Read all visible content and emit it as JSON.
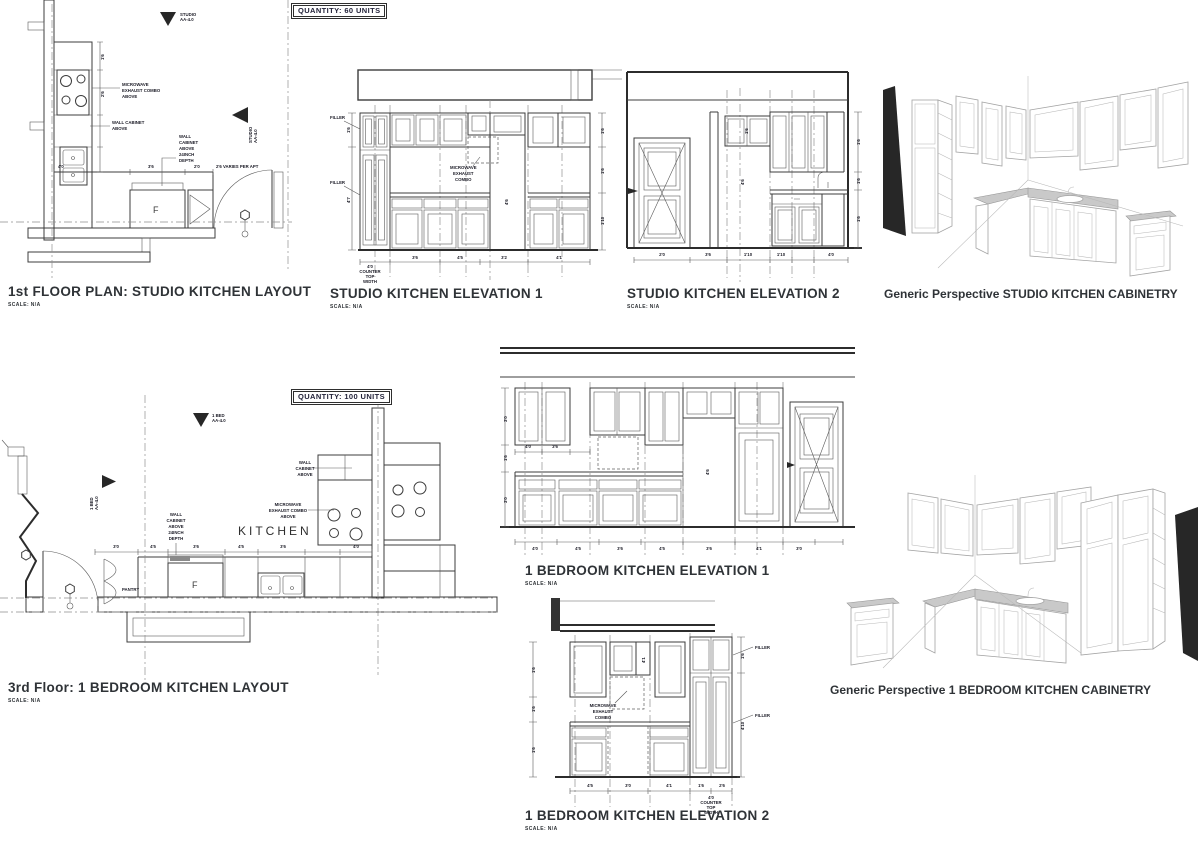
{
  "colors": {
    "line": "#3c3c3c",
    "grid": "#8f8f8f",
    "dark_fill": "#272727",
    "granite": "#c9c9c9",
    "title": "#2f3337"
  },
  "studio_plan": {
    "title": "1st FLOOR PLAN: STUDIO KITCHEN LAYOUT",
    "scale": "SCALE: N/A",
    "quantity": "QUANTITY: 60 UNITS",
    "fridge": "F",
    "marker_top": [
      "STUDIO",
      "AA-4.0"
    ],
    "marker_side": [
      "STUDIO",
      "AA-4.0"
    ],
    "note_microwave": [
      "MICROWAVE",
      "EXHAUST COMBO",
      "ABOVE"
    ],
    "note_wall_cabinet": [
      "WALL CABINET",
      "ABOVE"
    ],
    "note_wall_cabinet_depth": [
      "WALL",
      "CABINET",
      "ABOVE",
      "24INCH",
      "DEPTH"
    ],
    "dims": [
      "4'0",
      "3'6",
      "2'0",
      "2'6 VARIES PER APT",
      "1'6",
      "2'6"
    ]
  },
  "studio_el1": {
    "title": "STUDIO KITCHEN ELEVATION 1",
    "scale": "SCALE: N/A",
    "filler": "FILLER",
    "note_microwave": [
      "MICROWAVE",
      "EXHAUST",
      "COMBO"
    ],
    "counter_top": [
      "4'0",
      "COUNTER",
      "TOP",
      "WIDTH"
    ],
    "dims_bottom": [
      "3'6",
      "4'5",
      "3'2",
      "4'1"
    ],
    "dims_left": [
      "1'6",
      "4'7"
    ],
    "dims_right": [
      "1'6",
      "1'6",
      "1'10"
    ],
    "dim_fridge": "4'6"
  },
  "studio_el2": {
    "title": "STUDIO KITCHEN ELEVATION 2",
    "scale": "SCALE: N/A",
    "dims_bottom": [
      "2'0",
      "3'6",
      "1'10",
      "1'10",
      "4'0"
    ],
    "dims_right": [
      "1'6",
      "1'6",
      "1'6"
    ],
    "dim_tall": "4'6",
    "dim_upper": "1'6"
  },
  "studio_persp": {
    "title": "Generic Perspective STUDIO KITCHEN CABINETRY"
  },
  "bed_plan": {
    "title": "3rd Floor: 1 BEDROOM KITCHEN LAYOUT",
    "scale": "SCALE: N/A",
    "quantity": "QUANTITY: 100 UNITS",
    "kitchen": "KITCHEN",
    "pantry": "PANTRY",
    "fridge": "F",
    "marker_top": [
      "1 BED",
      "AA-4.0"
    ],
    "marker_side": [
      "1 BED",
      "AA-4.0"
    ],
    "note_microwave": [
      "MICROWAVE",
      "EXHAUST COMBO",
      "ABOVE"
    ],
    "note_wall_cabinet": [
      "WALL",
      "CABINET",
      "ABOVE"
    ],
    "note_wall_cabinet_depth": [
      "WALL",
      "CABINET",
      "ABOVE",
      "24INCH",
      "DEPTH"
    ],
    "dims_counter": [
      "3'0",
      "4'5",
      "3'6",
      "4'5",
      "3'6",
      "4'0"
    ]
  },
  "bed_el1": {
    "title": "1 BEDROOM KITCHEN ELEVATION 1",
    "scale": "SCALE: N/A",
    "dims_bottom": [
      "4'0",
      "4'5",
      "3'6",
      "4'5",
      "3'6",
      "4'1",
      "3'0"
    ],
    "dims_left": [
      "3'0",
      "1'6",
      "3'0"
    ],
    "dims_upper": [
      "4'0",
      "3'6"
    ],
    "dim_fridge": "4'6"
  },
  "bed_el2": {
    "title": "1 BEDROOM KITCHEN ELEVATION 2",
    "scale": "SCALE: N/A",
    "filler": "FILLER",
    "note_microwave": [
      "MICROWAVE",
      "EXHAUST",
      "COMBO"
    ],
    "dims_bottom": [
      "4'5",
      "3'0",
      "4'1",
      "1'6",
      "2'6"
    ],
    "counter_top": [
      "4'0",
      "COUNTER",
      "TOP",
      "WIDTH"
    ],
    "dims_left": [
      "1'6",
      "1'6",
      "1'6"
    ],
    "dims_right": [
      "1'6",
      "4'10"
    ],
    "dim_upper": "4'1"
  },
  "bed_persp": {
    "title": "Generic Perspective 1 BEDROOM KITCHEN CABINETRY"
  }
}
